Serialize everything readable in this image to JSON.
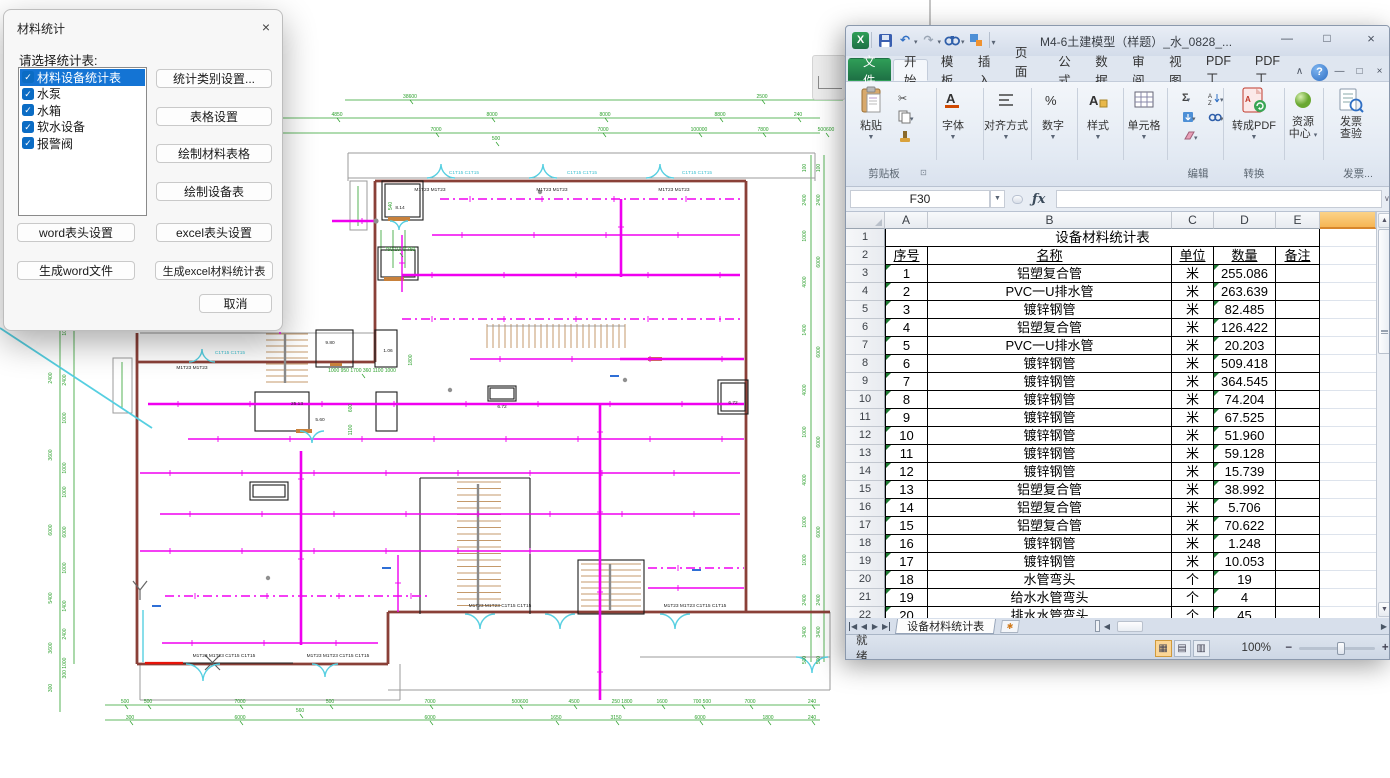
{
  "dialog": {
    "title": "材料统计",
    "close": "×",
    "label": "请选择统计表:",
    "items": [
      {
        "label": "材料设备统计表",
        "checked": true,
        "selected": true
      },
      {
        "label": "水泵",
        "checked": true,
        "selected": false
      },
      {
        "label": "水箱",
        "checked": true,
        "selected": false
      },
      {
        "label": "软水设备",
        "checked": true,
        "selected": false
      },
      {
        "label": "报警阀",
        "checked": true,
        "selected": false
      }
    ],
    "buttons_right": [
      "统计类别设置...",
      "表格设置",
      "绘制材料表格",
      "绘制设备表"
    ],
    "button_word_header": "word表头设置",
    "button_excel_header": "excel表头设置",
    "button_word_gen": "生成word文件",
    "button_excel_gen": "生成excel材料统计表",
    "button_cancel": "取消",
    "checkmark": "✓"
  },
  "excel": {
    "title": "M4-6土建模型（样题）_水_0828_...",
    "window_buttons": {
      "minimize": "—",
      "maximize": "□",
      "close": "×"
    },
    "qat": {
      "logo": "X",
      "undo": "↶",
      "redo": "↷",
      "drop": "▼",
      "pipe": "▼"
    },
    "tabs": [
      {
        "label": "文件",
        "kind": "file"
      },
      {
        "label": "开始",
        "active": true
      },
      {
        "label": "模板"
      },
      {
        "label": "插入"
      },
      {
        "label": "页面布"
      },
      {
        "label": "公式"
      },
      {
        "label": "数据"
      },
      {
        "label": "审阅"
      },
      {
        "label": "视图"
      },
      {
        "label": "PDF工"
      },
      {
        "label": "PDF工"
      }
    ],
    "tab_end_icons": {
      "collapse": "∧",
      "help": "?",
      "min": "—",
      "restore": "□",
      "close": "×"
    },
    "ribbon": {
      "paste": "粘贴",
      "clipboard_group": "剪贴板",
      "big_buttons": [
        "字体",
        "对齐方式",
        "数字",
        "样式",
        "单元格"
      ],
      "edit_group": "编辑",
      "sigma": "Σ",
      "pdf_button": "转成PDF",
      "convert_group": "转换",
      "resource_line1": "资源",
      "resource_line2": "中心",
      "invoice_line1": "发票",
      "invoice_line2": "查验",
      "invoice_group": "发票...",
      "drop": "▼"
    },
    "formula": {
      "name_box": "F30",
      "fx": "ƒx",
      "value": ""
    },
    "sheet": {
      "columns": [
        "A",
        "B",
        "C",
        "D",
        "E"
      ],
      "col_widths": [
        43,
        244,
        42,
        62,
        44
      ],
      "gutter_w": 39,
      "fcol_w": 56,
      "title_row": "设备材料统计表",
      "header_row": [
        "序号",
        "名称",
        "单位",
        "数量",
        "备注"
      ],
      "rows": [
        [
          "1",
          "铝塑复合管",
          "米",
          "255.086",
          ""
        ],
        [
          "2",
          "PVC一U排水管",
          "米",
          "263.639",
          ""
        ],
        [
          "3",
          "镀锌钢管",
          "米",
          "82.485",
          ""
        ],
        [
          "4",
          "铝塑复合管",
          "米",
          "126.422",
          ""
        ],
        [
          "5",
          "PVC一U排水管",
          "米",
          "20.203",
          ""
        ],
        [
          "6",
          "镀锌钢管",
          "米",
          "509.418",
          ""
        ],
        [
          "7",
          "镀锌钢管",
          "米",
          "364.545",
          ""
        ],
        [
          "8",
          "镀锌钢管",
          "米",
          "74.204",
          ""
        ],
        [
          "9",
          "镀锌钢管",
          "米",
          "67.525",
          ""
        ],
        [
          "10",
          "镀锌钢管",
          "米",
          "51.960",
          ""
        ],
        [
          "11",
          "镀锌钢管",
          "米",
          "59.128",
          ""
        ],
        [
          "12",
          "镀锌钢管",
          "米",
          "15.739",
          ""
        ],
        [
          "13",
          "铝塑复合管",
          "米",
          "38.992",
          ""
        ],
        [
          "14",
          "铝塑复合管",
          "米",
          "5.706",
          ""
        ],
        [
          "15",
          "铝塑复合管",
          "米",
          "70.622",
          ""
        ],
        [
          "16",
          "镀锌钢管",
          "米",
          "1.248",
          ""
        ],
        [
          "17",
          "镀锌钢管",
          "米",
          "10.053",
          ""
        ],
        [
          "18",
          "水管弯头",
          "个",
          "19",
          ""
        ],
        [
          "19",
          "给水水管弯头",
          "个",
          "4",
          ""
        ],
        [
          "20",
          "排水水管弯头",
          "个",
          "45",
          ""
        ]
      ]
    },
    "sheet_tab": "设备材料统计表",
    "status": {
      "ready": "就绪",
      "zoom": "100%"
    },
    "colors": {
      "file_green": "#1e7145",
      "sel_header": "#f6b554"
    }
  },
  "cad": {
    "colors": {
      "dim_green": "#2ca02c",
      "pipe_magenta": "#f000f0",
      "wall_maroon": "#8a4038",
      "door_cyan": "#56cfe1"
    },
    "texts": [
      {
        "t": "38600",
        "x": 410,
        "y": 98,
        "c": "g"
      },
      {
        "t": "2500",
        "x": 762,
        "y": 98,
        "c": "g"
      },
      {
        "t": "4850",
        "x": 337,
        "y": 116,
        "c": "g"
      },
      {
        "t": "8000",
        "x": 492,
        "y": 116,
        "c": "g"
      },
      {
        "t": "8000",
        "x": 605,
        "y": 116,
        "c": "g"
      },
      {
        "t": "8800",
        "x": 720,
        "y": 116,
        "c": "g"
      },
      {
        "t": "240",
        "x": 798,
        "y": 116,
        "c": "g"
      },
      {
        "t": "900 800 850 1200 850 1200 850 300",
        "x": 240,
        "y": 131,
        "c": "g"
      },
      {
        "t": "7000",
        "x": 436,
        "y": 131,
        "c": "g"
      },
      {
        "t": "500",
        "x": 496,
        "y": 140,
        "c": "g"
      },
      {
        "t": "7000",
        "x": 603,
        "y": 131,
        "c": "g"
      },
      {
        "t": "100000",
        "x": 699,
        "y": 131,
        "c": "g"
      },
      {
        "t": "7800",
        "x": 763,
        "y": 131,
        "c": "g"
      },
      {
        "t": "500600",
        "x": 826,
        "y": 131,
        "c": "g"
      },
      {
        "t": "500",
        "x": 125,
        "y": 703,
        "c": "g"
      },
      {
        "t": "500",
        "x": 148,
        "y": 703,
        "c": "g"
      },
      {
        "t": "7000",
        "x": 240,
        "y": 703,
        "c": "g"
      },
      {
        "t": "500",
        "x": 330,
        "y": 703,
        "c": "g"
      },
      {
        "t": "7000",
        "x": 430,
        "y": 703,
        "c": "g"
      },
      {
        "t": "500600",
        "x": 520,
        "y": 703,
        "c": "g"
      },
      {
        "t": "4500",
        "x": 574,
        "y": 703,
        "c": "g"
      },
      {
        "t": "250 1800",
        "x": 622,
        "y": 703,
        "c": "g"
      },
      {
        "t": "1600",
        "x": 662,
        "y": 703,
        "c": "g"
      },
      {
        "t": "700 500",
        "x": 702,
        "y": 703,
        "c": "g"
      },
      {
        "t": "7000",
        "x": 750,
        "y": 703,
        "c": "g"
      },
      {
        "t": "240",
        "x": 812,
        "y": 703,
        "c": "g"
      },
      {
        "t": "300",
        "x": 130,
        "y": 719,
        "c": "g"
      },
      {
        "t": "6000",
        "x": 240,
        "y": 719,
        "c": "g"
      },
      {
        "t": "560",
        "x": 300,
        "y": 712,
        "c": "g"
      },
      {
        "t": "6000",
        "x": 430,
        "y": 719,
        "c": "g"
      },
      {
        "t": "1650",
        "x": 556,
        "y": 719,
        "c": "g"
      },
      {
        "t": "3150",
        "x": 616,
        "y": 719,
        "c": "g"
      },
      {
        "t": "6000",
        "x": 700,
        "y": 719,
        "c": "g"
      },
      {
        "t": "1800",
        "x": 768,
        "y": 719,
        "c": "g"
      },
      {
        "t": "240",
        "x": 812,
        "y": 719,
        "c": "g"
      },
      {
        "t": "3600",
        "x": 52,
        "y": 180,
        "c": "g",
        "r": 1
      },
      {
        "t": "2400",
        "x": 52,
        "y": 250,
        "c": "g",
        "r": 1
      },
      {
        "t": "2400",
        "x": 52,
        "y": 312,
        "c": "g",
        "r": 1
      },
      {
        "t": "2400",
        "x": 52,
        "y": 378,
        "c": "g",
        "r": 1
      },
      {
        "t": "3600",
        "x": 52,
        "y": 455,
        "c": "g",
        "r": 1
      },
      {
        "t": "6000",
        "x": 52,
        "y": 530,
        "c": "g",
        "r": 1
      },
      {
        "t": "5400",
        "x": 52,
        "y": 598,
        "c": "g",
        "r": 1
      },
      {
        "t": "3600",
        "x": 52,
        "y": 648,
        "c": "g",
        "r": 1
      },
      {
        "t": "300",
        "x": 52,
        "y": 688,
        "c": "g",
        "r": 1
      },
      {
        "t": "1000",
        "x": 66,
        "y": 152,
        "c": "g",
        "r": 1
      },
      {
        "t": "1400",
        "x": 66,
        "y": 188,
        "c": "g",
        "r": 1
      },
      {
        "t": "2400",
        "x": 66,
        "y": 255,
        "c": "g",
        "r": 1
      },
      {
        "t": "1000",
        "x": 66,
        "y": 330,
        "c": "g",
        "r": 1
      },
      {
        "t": "2400",
        "x": 66,
        "y": 380,
        "c": "g",
        "r": 1
      },
      {
        "t": "1000",
        "x": 66,
        "y": 418,
        "c": "g",
        "r": 1
      },
      {
        "t": "1000",
        "x": 66,
        "y": 468,
        "c": "g",
        "r": 1
      },
      {
        "t": "1000",
        "x": 66,
        "y": 492,
        "c": "g",
        "r": 1
      },
      {
        "t": "6000",
        "x": 66,
        "y": 532,
        "c": "g",
        "r": 1
      },
      {
        "t": "1000",
        "x": 66,
        "y": 568,
        "c": "g",
        "r": 1
      },
      {
        "t": "1400",
        "x": 66,
        "y": 606,
        "c": "g",
        "r": 1
      },
      {
        "t": "2400",
        "x": 66,
        "y": 634,
        "c": "g",
        "r": 1
      },
      {
        "t": "300 1000",
        "x": 66,
        "y": 668,
        "c": "g",
        "r": 1
      },
      {
        "t": "100",
        "x": 806,
        "y": 168,
        "c": "g",
        "r": 1
      },
      {
        "t": "2400",
        "x": 806,
        "y": 200,
        "c": "g",
        "r": 1
      },
      {
        "t": "1000",
        "x": 806,
        "y": 236,
        "c": "g",
        "r": 1
      },
      {
        "t": "4000",
        "x": 806,
        "y": 282,
        "c": "g",
        "r": 1
      },
      {
        "t": "1400",
        "x": 806,
        "y": 330,
        "c": "g",
        "r": 1
      },
      {
        "t": "4000",
        "x": 806,
        "y": 390,
        "c": "g",
        "r": 1
      },
      {
        "t": "1000",
        "x": 806,
        "y": 432,
        "c": "g",
        "r": 1
      },
      {
        "t": "4000",
        "x": 806,
        "y": 480,
        "c": "g",
        "r": 1
      },
      {
        "t": "1000",
        "x": 806,
        "y": 522,
        "c": "g",
        "r": 1
      },
      {
        "t": "1000",
        "x": 806,
        "y": 560,
        "c": "g",
        "r": 1
      },
      {
        "t": "2400",
        "x": 806,
        "y": 600,
        "c": "g",
        "r": 1
      },
      {
        "t": "3400",
        "x": 806,
        "y": 632,
        "c": "g",
        "r": 1
      },
      {
        "t": "500",
        "x": 806,
        "y": 660,
        "c": "g",
        "r": 1
      },
      {
        "t": "100",
        "x": 820,
        "y": 168,
        "c": "g",
        "r": 1
      },
      {
        "t": "2400",
        "x": 820,
        "y": 200,
        "c": "g",
        "r": 1
      },
      {
        "t": "6000",
        "x": 820,
        "y": 262,
        "c": "g",
        "r": 1
      },
      {
        "t": "6000",
        "x": 820,
        "y": 352,
        "c": "g",
        "r": 1
      },
      {
        "t": "6000",
        "x": 820,
        "y": 442,
        "c": "g",
        "r": 1
      },
      {
        "t": "6000",
        "x": 820,
        "y": 532,
        "c": "g",
        "r": 1
      },
      {
        "t": "2400",
        "x": 820,
        "y": 600,
        "c": "g",
        "r": 1
      },
      {
        "t": "3400",
        "x": 820,
        "y": 632,
        "c": "g",
        "r": 1
      },
      {
        "t": "500",
        "x": 820,
        "y": 660,
        "c": "g",
        "r": 1
      },
      {
        "t": "750 1000 750",
        "x": 400,
        "y": 251,
        "c": "g"
      },
      {
        "t": "1000 950 1700 360 1100 1000",
        "x": 362,
        "y": 372,
        "c": "g"
      },
      {
        "t": "1800",
        "x": 412,
        "y": 360,
        "c": "g",
        "r": 1
      },
      {
        "t": "600",
        "x": 352,
        "y": 408,
        "c": "g",
        "r": 1
      },
      {
        "t": "1100",
        "x": 352,
        "y": 430,
        "c": "g",
        "r": 1
      },
      {
        "t": "540",
        "x": 392,
        "y": 206,
        "c": "g",
        "r": 1
      },
      {
        "t": "C1T15 C1T15",
        "x": 464,
        "y": 174,
        "c": "c"
      },
      {
        "t": "C1T15 C1T15",
        "x": 582,
        "y": 174,
        "c": "c"
      },
      {
        "t": "C1T15 C1T15",
        "x": 697,
        "y": 174,
        "c": "c"
      },
      {
        "t": "C1T15 C1T15",
        "x": 230,
        "y": 354,
        "c": "c"
      },
      {
        "t": "M1T23 M1T23",
        "x": 430,
        "y": 191,
        "c": "k"
      },
      {
        "t": "M1T23 M1T23",
        "x": 552,
        "y": 191,
        "c": "k"
      },
      {
        "t": "M1T23 M1T23",
        "x": 674,
        "y": 191,
        "c": "k"
      },
      {
        "t": "M1T23 M1T23",
        "x": 192,
        "y": 369,
        "c": "k"
      },
      {
        "t": "M1T23 M1T23 C1T15 C1T15",
        "x": 500,
        "y": 607,
        "c": "k"
      },
      {
        "t": "M1T23 M1T23 C1T15 C1T15",
        "x": 695,
        "y": 607,
        "c": "k"
      },
      {
        "t": "M1T23 M1T23 C1T15 C1T15",
        "x": 224,
        "y": 657,
        "c": "k"
      },
      {
        "t": "M1T23 M1T23 C1T15 C1T15",
        "x": 338,
        "y": 657,
        "c": "k"
      },
      {
        "t": "8.14",
        "x": 400,
        "y": 209,
        "c": "k"
      },
      {
        "t": "9.80",
        "x": 330,
        "y": 344,
        "c": "k"
      },
      {
        "t": "1.06",
        "x": 388,
        "y": 352,
        "c": "k"
      },
      {
        "t": "25.13",
        "x": 297,
        "y": 405,
        "c": "k"
      },
      {
        "t": "5.60",
        "x": 320,
        "y": 421,
        "c": "k"
      },
      {
        "t": "6.72",
        "x": 502,
        "y": 408,
        "c": "k"
      },
      {
        "t": "6.72",
        "x": 733,
        "y": 404,
        "c": "k"
      }
    ]
  }
}
